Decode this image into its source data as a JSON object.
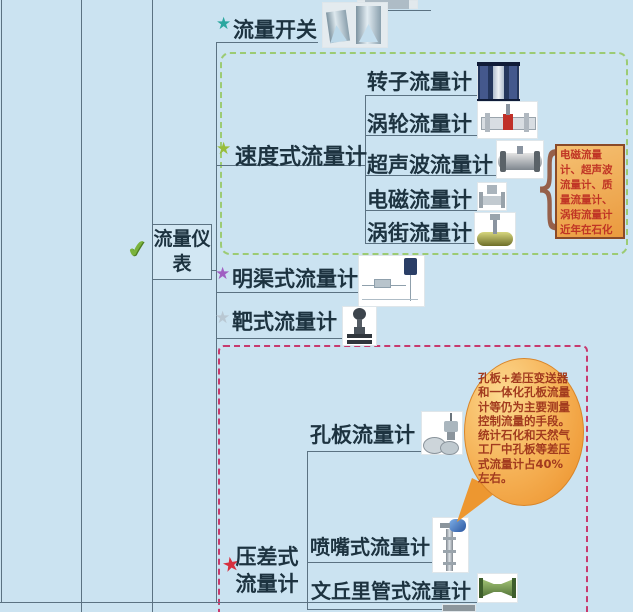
{
  "mindmap": {
    "root": {
      "label": "流量仪表"
    },
    "branches": [
      {
        "label": "流量开关",
        "star_color": "#2aa79f"
      },
      {
        "label": "速度式流量计",
        "star_color": "#98bd3a",
        "children": [
          {
            "label": "转子流量计"
          },
          {
            "label": "涡轮流量计"
          },
          {
            "label": "超声波流量计"
          },
          {
            "label": "电磁流量计"
          },
          {
            "label": "涡街流量计"
          }
        ]
      },
      {
        "label": "明渠式流量计",
        "star_color": "#a05fc2"
      },
      {
        "label": "靶式流量计",
        "star_color": "#b9c8d3"
      },
      {
        "label": "压差式流量计",
        "star_color": "#d6303e",
        "children": [
          {
            "label": "孔板流量计"
          },
          {
            "label": "喷嘴式流量计"
          },
          {
            "label": "文丘里管式流量计"
          }
        ]
      }
    ],
    "notes": {
      "velocity_note": "电磁流量计、超声波流量计、质量流量计、涡街流量计近年在石化较大使用",
      "dp_note": "孔板+差压变送器和一体化孔板流量计等仍为主要测量控制流量的手段。统计石化和天然气工厂中孔板等差压式流量计占40%左右。"
    }
  },
  "icons": {
    "star_glyph": "★",
    "check_glyph": "✔",
    "brace_glyph": "{"
  },
  "colors": {
    "background": "#cbe3f1",
    "tree_line": "#5b7282",
    "text": "#1d3340",
    "green_group_border": "#9ccb74",
    "pink_group_border": "#c73a6e",
    "note_background": "#eda04e",
    "note_border": "#8a4a28",
    "note_text": "#c03525",
    "bubble_orange": "#ec8f28",
    "star_teal": "#2aa79f",
    "star_green": "#98bd3a",
    "star_purple": "#a05fc2",
    "star_silver": "#b9c8d3",
    "star_red": "#d6303e"
  }
}
